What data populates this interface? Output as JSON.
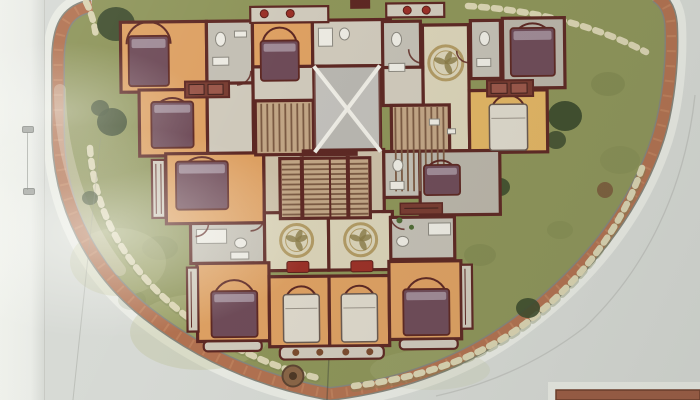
{
  "scene": {
    "kind": "photographed architectural site plan (typical floor plan of residential building)",
    "site": {
      "lawn": "olive green landscaped fan-shaped site",
      "perimeter_path": "curved terracotta brick walkway band with white margin",
      "stepping_stone_trails": 4,
      "trees": 7,
      "fountain_planters": 1
    },
    "building": {
      "bedrooms": 11,
      "bathrooms": 7,
      "living_rooms_with_floor_medallions": 3,
      "elevator_shaft": 1,
      "stair_flights": 3,
      "balconies": 9,
      "red_sofas": 2,
      "red_flower_pots": 4,
      "brown_planter_pots": 4,
      "wardrobes": 2
    },
    "paper": {
      "left_margin_strip": true,
      "staple": true,
      "flash_glare_left": true,
      "second_drawing_edge_bottom_right": true
    }
  },
  "colors": {
    "paper": "#d6d9d4",
    "paper_bright": "#eef0ea",
    "left_strip": "#e9ebe6",
    "margin_white": "#e8eae3",
    "band": "#b3714e",
    "band_light": "#cf9069",
    "band_edge": "#85857b",
    "lawn": "#8d9457",
    "lawn_dark": "#5f6b38",
    "lawn_light": "#b9bd88",
    "stones": "#d9d3b0",
    "stone_shadow": "#78804f",
    "wall": "#5f2822",
    "floor_orange": "#dfa05f",
    "floor_yellow": "#e3b45f",
    "floor_cream": "#d9d2b6",
    "floor_gray": "#b9b4a8",
    "floor_hall": "#cfc9ba",
    "floor_bath": "#c3bfb4",
    "floor_stone": "#cbbfa6",
    "stair_bg": "#c2a583",
    "stair_line": "#7c5a42",
    "shaft_bg": "#b8b6b0",
    "shaft_line": "#eceae2",
    "bed_purple": "#6f4b58",
    "bed_pillow": "#a08a96",
    "bed_white": "#ddd8ca",
    "red_accent": "#9e2f26",
    "pot_brown": "#7c4b2c",
    "tree_dark": "#3c4a2b",
    "tree_brown": "#7a5a38",
    "fountain": "#8a6544",
    "panel_brick": "#9c5b41",
    "medallion_ring": "#b29a62",
    "medallion_leaf": "#8a7a45"
  }
}
